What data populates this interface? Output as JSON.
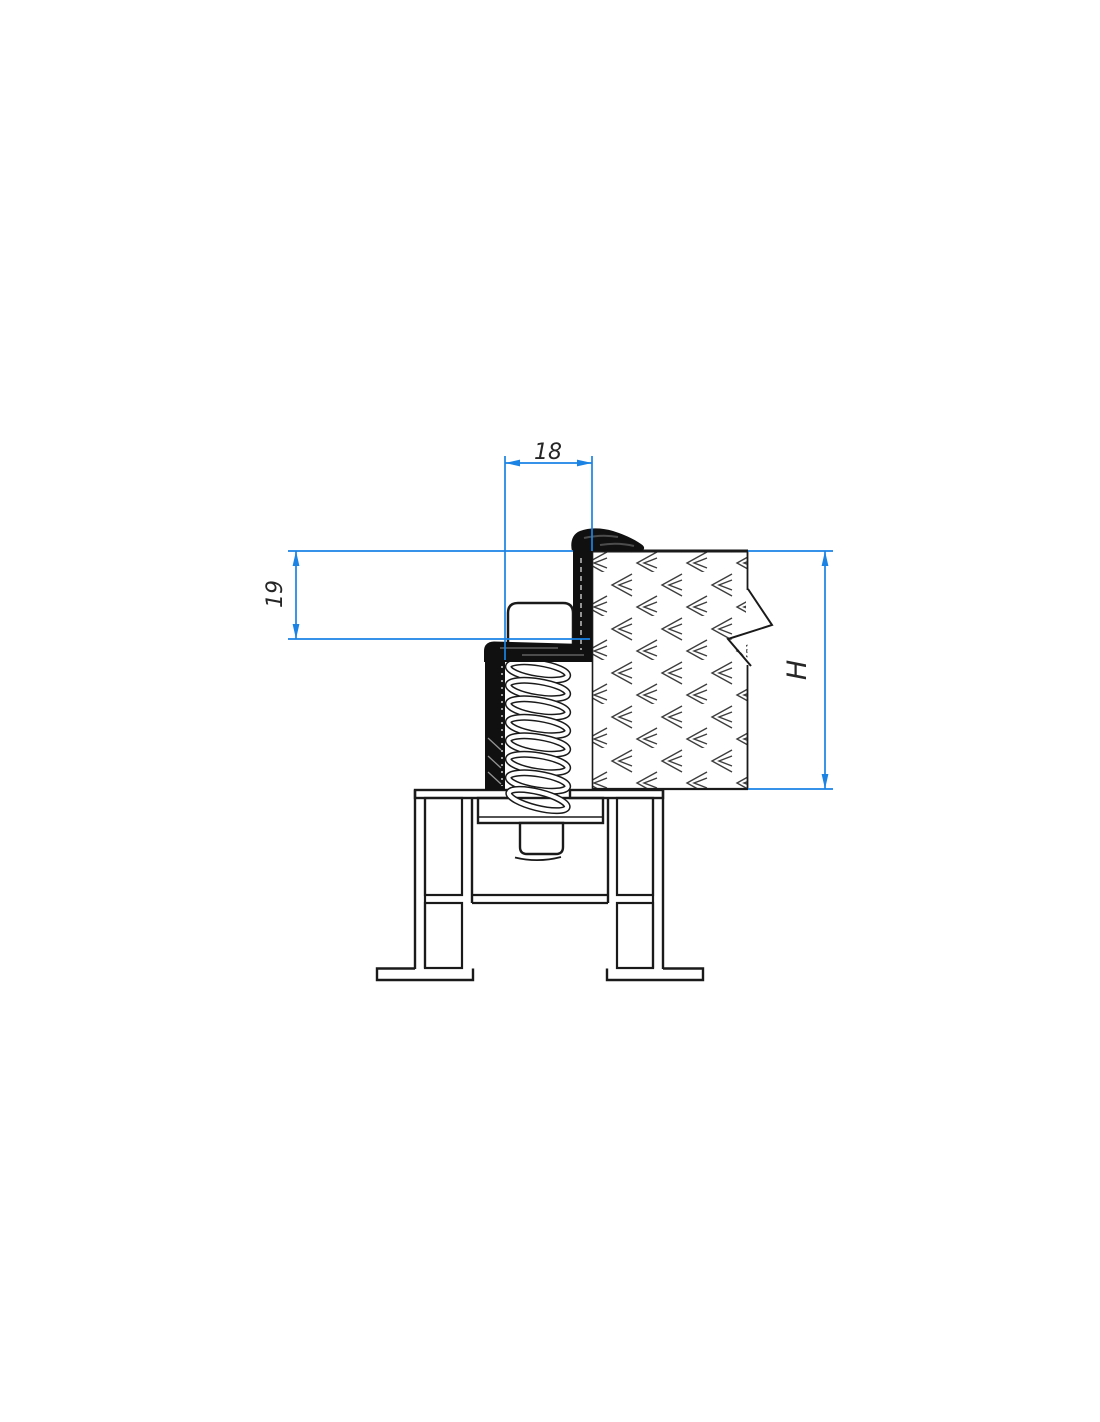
{
  "drawing": {
    "dimensions": {
      "top_width": "18",
      "left_height": "19",
      "right_height": "H"
    },
    "colors": {
      "dimension_blue": "#1a83e4",
      "outline_black": "#1a1a1a",
      "seal_black": "#101010",
      "hatch_gray": "#3d3d3d",
      "background": "#ffffff"
    }
  }
}
